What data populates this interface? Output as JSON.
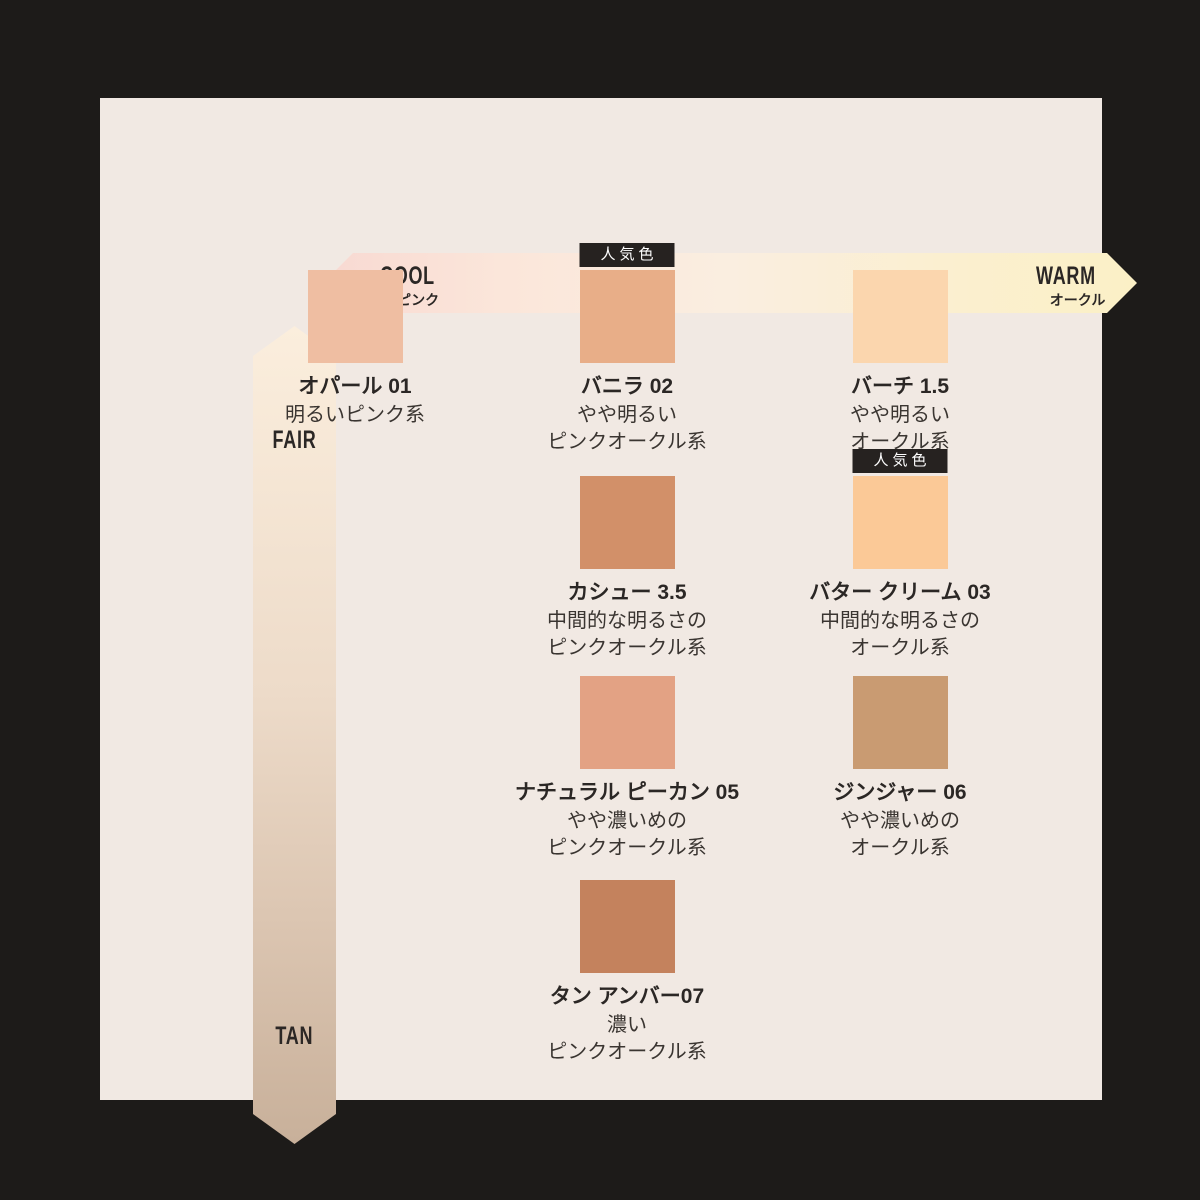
{
  "axes": {
    "horizontal": {
      "left_label": "COOL",
      "left_sublabel": "ピンク",
      "right_label": "WARM",
      "right_sublabel": "オークル",
      "gradient": [
        "#F8D9D2",
        "#FAEEE0",
        "#FBF0C6"
      ]
    },
    "vertical": {
      "top_label": "FAIR",
      "bottom_label": "TAN",
      "gradient": [
        "#FBEEDD",
        "#C8B09A"
      ]
    }
  },
  "popular_badge_label": "人気色",
  "shades": [
    {
      "name": "オパール 01",
      "desc": [
        "明るいピンク系"
      ],
      "color": "#EFBEA2",
      "popular": false,
      "col": 1,
      "row": 1
    },
    {
      "name": "バニラ 02",
      "desc": [
        "やや明るい",
        "ピンクオークル系"
      ],
      "color": "#E8AE88",
      "popular": true,
      "col": 2,
      "row": 1
    },
    {
      "name": "バーチ 1.5",
      "desc": [
        "やや明るい",
        "オークル系"
      ],
      "color": "#FBD6AE",
      "popular": false,
      "col": 3,
      "row": 1
    },
    {
      "name": "カシュー 3.5",
      "desc": [
        "中間的な明るさの",
        "ピンクオークル系"
      ],
      "color": "#D29069",
      "popular": false,
      "col": 2,
      "row": 2
    },
    {
      "name": "バター クリーム 03",
      "desc": [
        "中間的な明るさの",
        "オークル系"
      ],
      "color": "#FBC997",
      "popular": true,
      "col": 3,
      "row": 2
    },
    {
      "name": "ナチュラル ピーカン 05",
      "desc": [
        "やや濃いめの",
        "ピンクオークル系"
      ],
      "color": "#E3A284",
      "popular": false,
      "col": 2,
      "row": 3
    },
    {
      "name": "ジンジャー 06",
      "desc": [
        "やや濃いめの",
        "オークル系"
      ],
      "color": "#C99B72",
      "popular": false,
      "col": 3,
      "row": 3
    },
    {
      "name": "タン アンバー07",
      "desc": [
        "濃い",
        "ピンクオークル系"
      ],
      "color": "#C4825D",
      "popular": false,
      "col": 2,
      "row": 4
    }
  ],
  "colors": {
    "frame": "#1D1B19",
    "panel": "#F1E9E3",
    "badge_bg": "#262220",
    "text": "#2B2725"
  }
}
